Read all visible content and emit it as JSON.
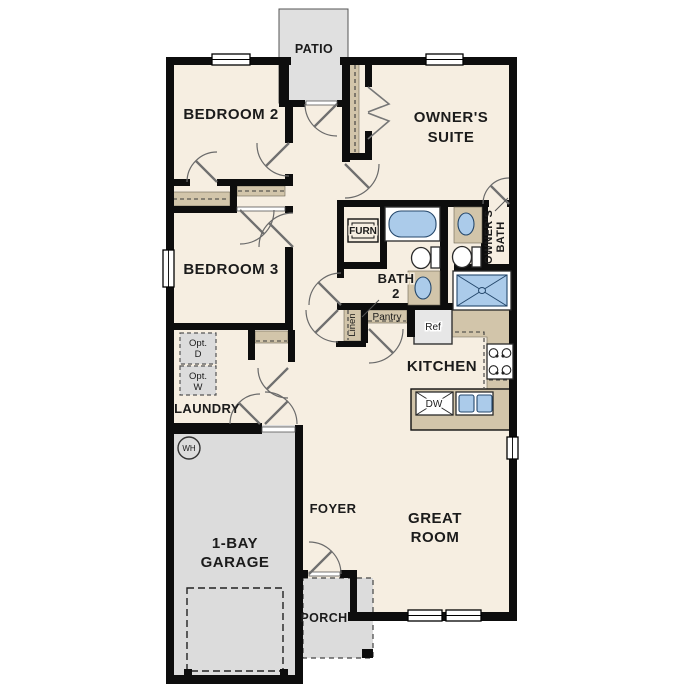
{
  "title": "Single-story floor plan",
  "colors": {
    "wall": "#0d0d0d",
    "floor": "#f6eee1",
    "concrete": "#dcdcdc",
    "patio": "#e0e0e0",
    "cabinet_tan": "#d2c5aa",
    "fixture_blue": "#abcbea"
  },
  "labels": {
    "patio": "PATIO",
    "bedroom2": "BEDROOM 2",
    "owners_suite_1": "OWNER'S",
    "owners_suite_2": "SUITE",
    "bedroom3": "BEDROOM 3",
    "furn": "FURN",
    "bath2_1": "BATH",
    "bath2_2": "2",
    "owners_bath_1": "OWNER'S",
    "owners_bath_2": "BATH",
    "linen": "Linen",
    "pantry": "Pantry",
    "ref": "Ref",
    "kitchen": "KITCHEN",
    "laundry": "LAUNDRY",
    "opt_d_1": "Opt.",
    "opt_d_2": "D",
    "opt_w_1": "Opt.",
    "opt_w_2": "W",
    "wh": "WH",
    "garage_1": "1-BAY",
    "garage_2": "GARAGE",
    "foyer": "FOYER",
    "great_room_1": "GREAT",
    "great_room_2": "ROOM",
    "porch": "PORCH",
    "dw": "DW"
  }
}
